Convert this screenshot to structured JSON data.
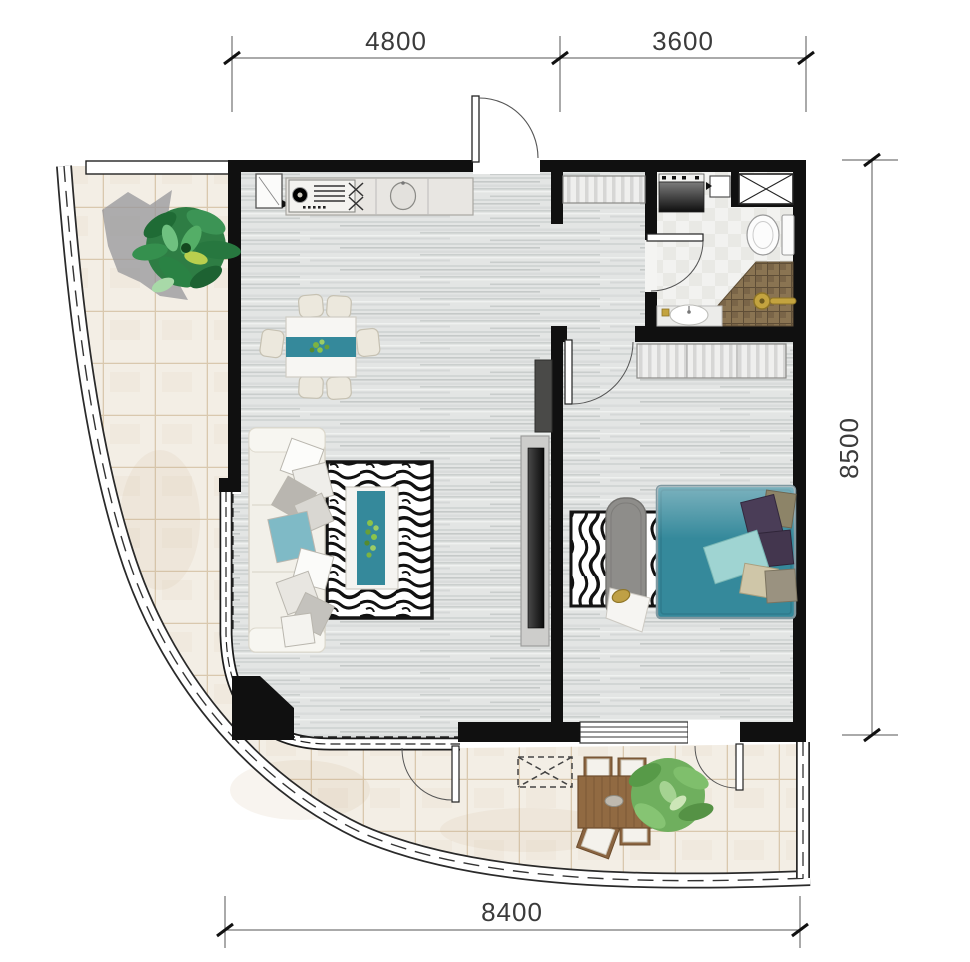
{
  "canvas": {
    "width": 970,
    "height": 962
  },
  "dims": {
    "top": [
      {
        "label": "4800"
      },
      {
        "label": "3600"
      }
    ],
    "right": [
      {
        "label": "8500"
      }
    ],
    "bottom": [
      {
        "label": "8400"
      }
    ]
  },
  "colors": {
    "wall": "#101010",
    "teal": "#35899b",
    "teal_light": "#9fd4d2",
    "sofa_teal_pillow": "#7fbac6",
    "gold": "#c3a33f",
    "floor_wood_base": "#e3e5e4",
    "balcony_tile": "#f3eee5",
    "tile_grout": "#d9c8ae",
    "shower_tile": "#8a7452",
    "sofa_cream": "#f2f0e9",
    "bench_grey": "#8e8d8a",
    "plant_green": "#2e7d44",
    "dim_line": "#444444"
  },
  "icons": [
    "gas-stove",
    "kitchen-sink",
    "refrigerator",
    "entry-door",
    "dining-set",
    "sofa",
    "zebra-rug",
    "coffee-table",
    "tv",
    "entry-closet",
    "washing-machine",
    "vent-shaft",
    "toilet",
    "shower",
    "vanity-sink",
    "wardrobe",
    "double-bed",
    "bench",
    "balcony-railing",
    "outdoor-dining-set",
    "ac-unit",
    "potted-plant"
  ]
}
